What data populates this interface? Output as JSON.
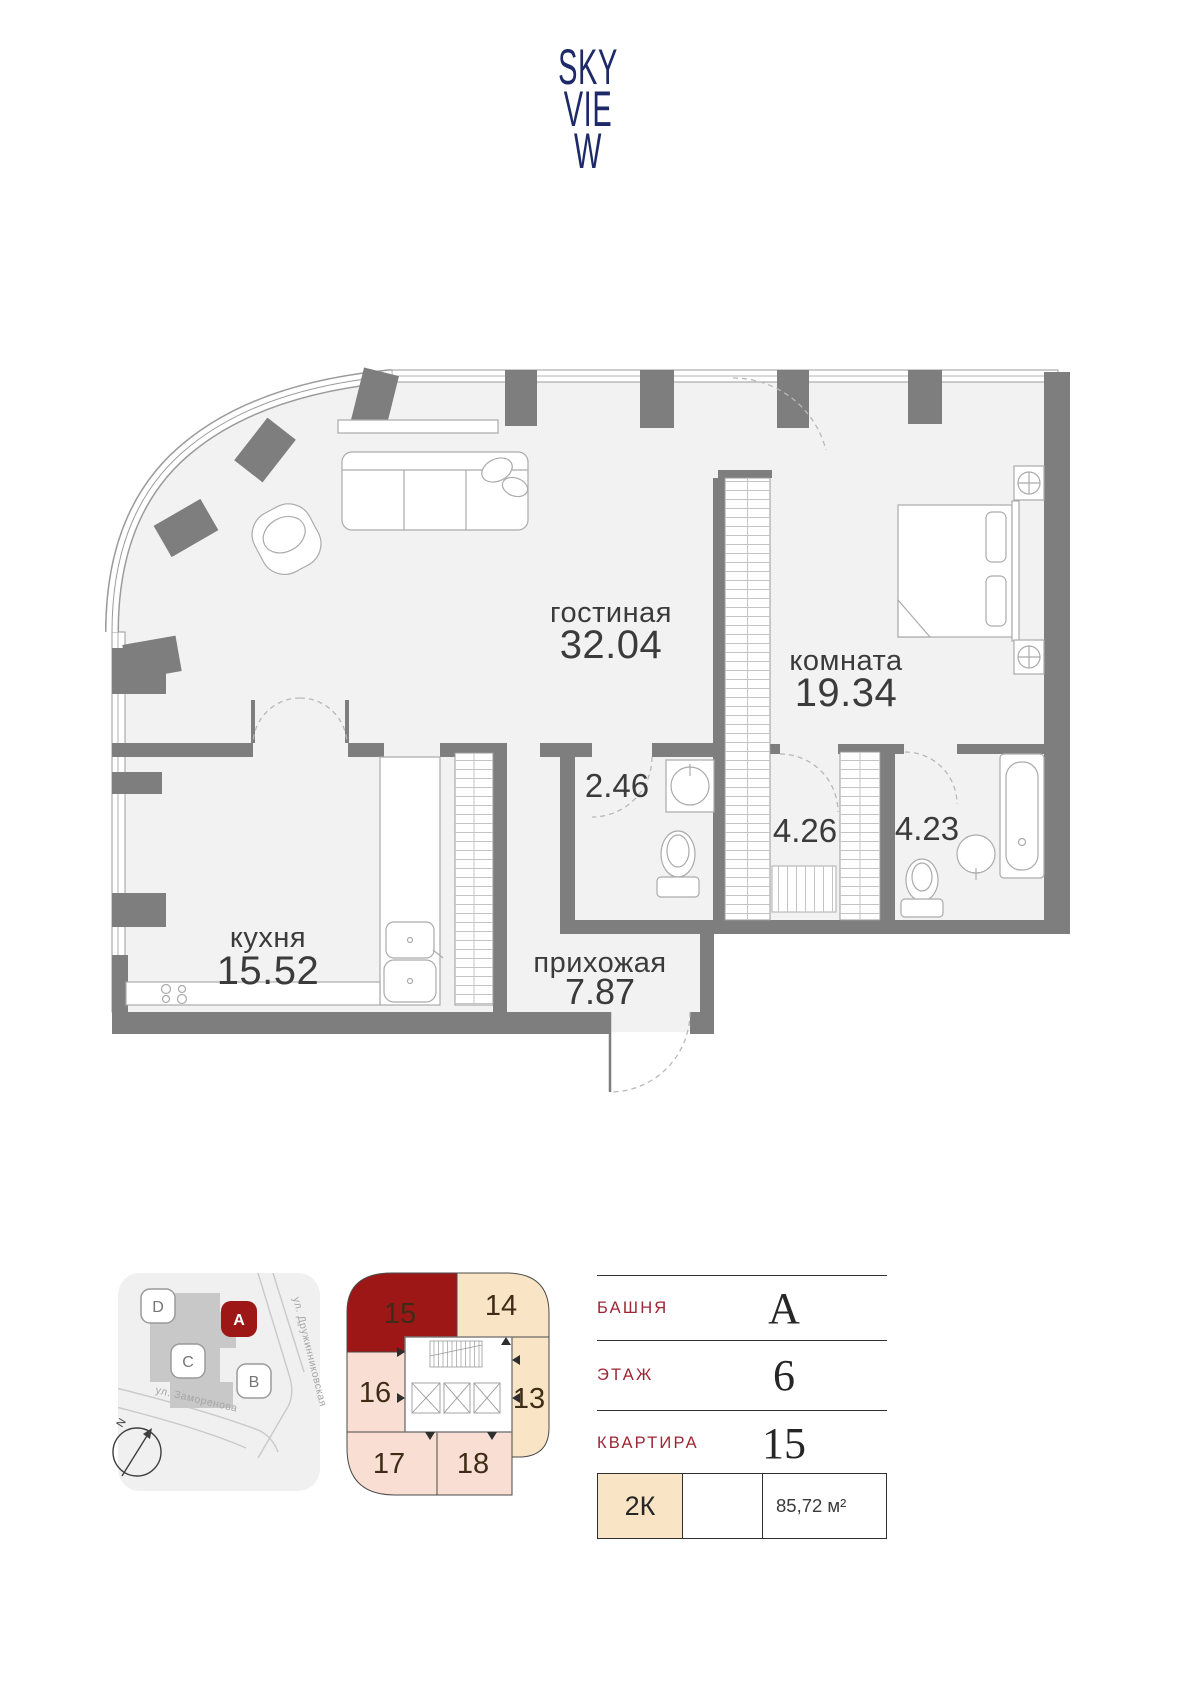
{
  "logo": {
    "line1": "SKY",
    "line2": "VIE",
    "line3": "W"
  },
  "floor_plan": {
    "living": {
      "name": "гостиная",
      "area": "32.04"
    },
    "bedroom": {
      "name": "комната",
      "area": "19.34"
    },
    "kitchen": {
      "name": "кухня",
      "area": "15.52"
    },
    "hall": {
      "name": "прихожая",
      "area": "7.87"
    },
    "wc": {
      "area": "2.46"
    },
    "closet": {
      "area": "4.26"
    },
    "bathroom": {
      "area": "4.23"
    }
  },
  "site_map": {
    "buildings": [
      {
        "label": "D",
        "selected": false
      },
      {
        "label": "A",
        "selected": true
      },
      {
        "label": "C",
        "selected": false
      },
      {
        "label": "B",
        "selected": false
      }
    ],
    "streets": [
      {
        "name": "ул. Дружинниковская"
      },
      {
        "name": "ул. Заморенова"
      }
    ],
    "compass_label": "N"
  },
  "floor_plate": {
    "units": [
      {
        "number": "15",
        "selected": true
      },
      {
        "number": "14",
        "selected": false
      },
      {
        "number": "16",
        "selected": false
      },
      {
        "number": "13",
        "selected": false
      },
      {
        "number": "17",
        "selected": false
      },
      {
        "number": "18",
        "selected": false
      }
    ]
  },
  "details": {
    "rows": [
      {
        "label": "БАШНЯ",
        "value": "А"
      },
      {
        "label": "ЭТАЖ",
        "value": "6"
      },
      {
        "label": "КВАРТИРА",
        "value": "15"
      }
    ],
    "type": "2К",
    "total_area": "85,72 м²"
  },
  "colors": {
    "accent_red": "#9e1717",
    "navy": "#1d2a67",
    "cream": "#f9e5c5",
    "pink": "#f8ded3",
    "wall_gray": "#7e7e7e",
    "label_red": "#9e2533"
  }
}
